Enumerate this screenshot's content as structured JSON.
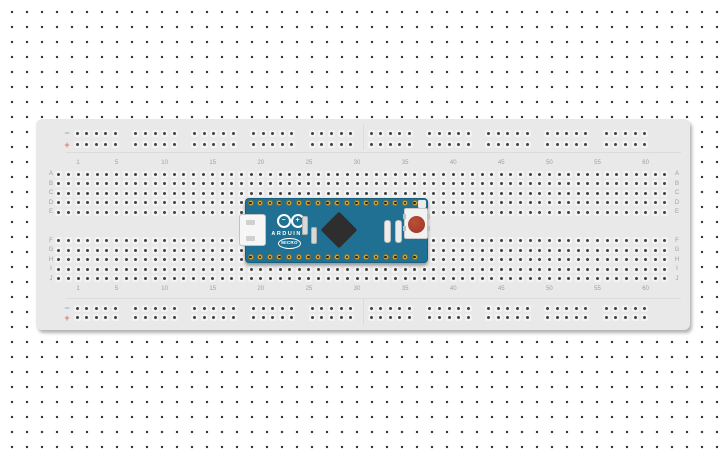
{
  "app": {
    "canvas_background": "#ffffff",
    "grid_dot_color": "#333333"
  },
  "breadboard": {
    "body_color": "#e9e9e9",
    "hole_color": "#424242",
    "hole_pad_color": "#f3f3f3",
    "label_color": "#a0a0a0",
    "columns": 60,
    "column_labels": [
      "1",
      "5",
      "10",
      "15",
      "20",
      "25",
      "30",
      "35",
      "40",
      "45",
      "50",
      "55",
      "60"
    ],
    "rows_top": [
      "A",
      "B",
      "C",
      "D",
      "E"
    ],
    "rows_bottom": [
      "F",
      "G",
      "H",
      "I",
      "J"
    ],
    "holes_per_row": 64,
    "rails": {
      "minus_symbol": "−",
      "plus_symbol": "+",
      "minus_color": "#82b1d4",
      "plus_color": "#e47676",
      "groups": 10,
      "holes_per_group": 5
    }
  },
  "arduino": {
    "board_color": "#1f7093",
    "brand": "ARDUINO",
    "model": "MICRO",
    "logo_minus": "−",
    "logo_plus": "+",
    "pins_per_side": 18,
    "pin_color": "#d3ab44",
    "chip_color": "#2e2e2e",
    "reset_button_color": "#9c3423"
  }
}
